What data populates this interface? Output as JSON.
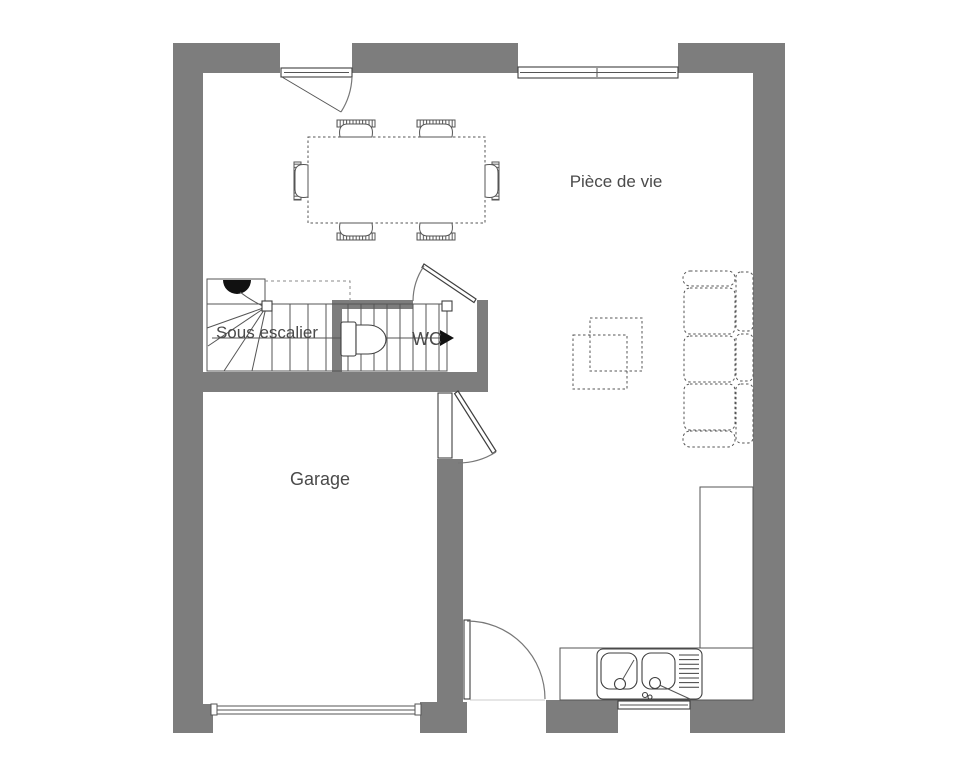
{
  "document": {
    "type": "floor-plan"
  },
  "labels": {
    "living_room": "Pièce de vie",
    "under_stairs": "Sous escalier",
    "wc": "WC",
    "garage": "Garage"
  },
  "colors": {
    "wall": "#7d7d7d",
    "outline": "#3f3f3f",
    "furn": "#555555",
    "light": "#8a8a8a",
    "text": "#4a4a4a",
    "bg": "#ffffff",
    "fixture": "#111111"
  }
}
